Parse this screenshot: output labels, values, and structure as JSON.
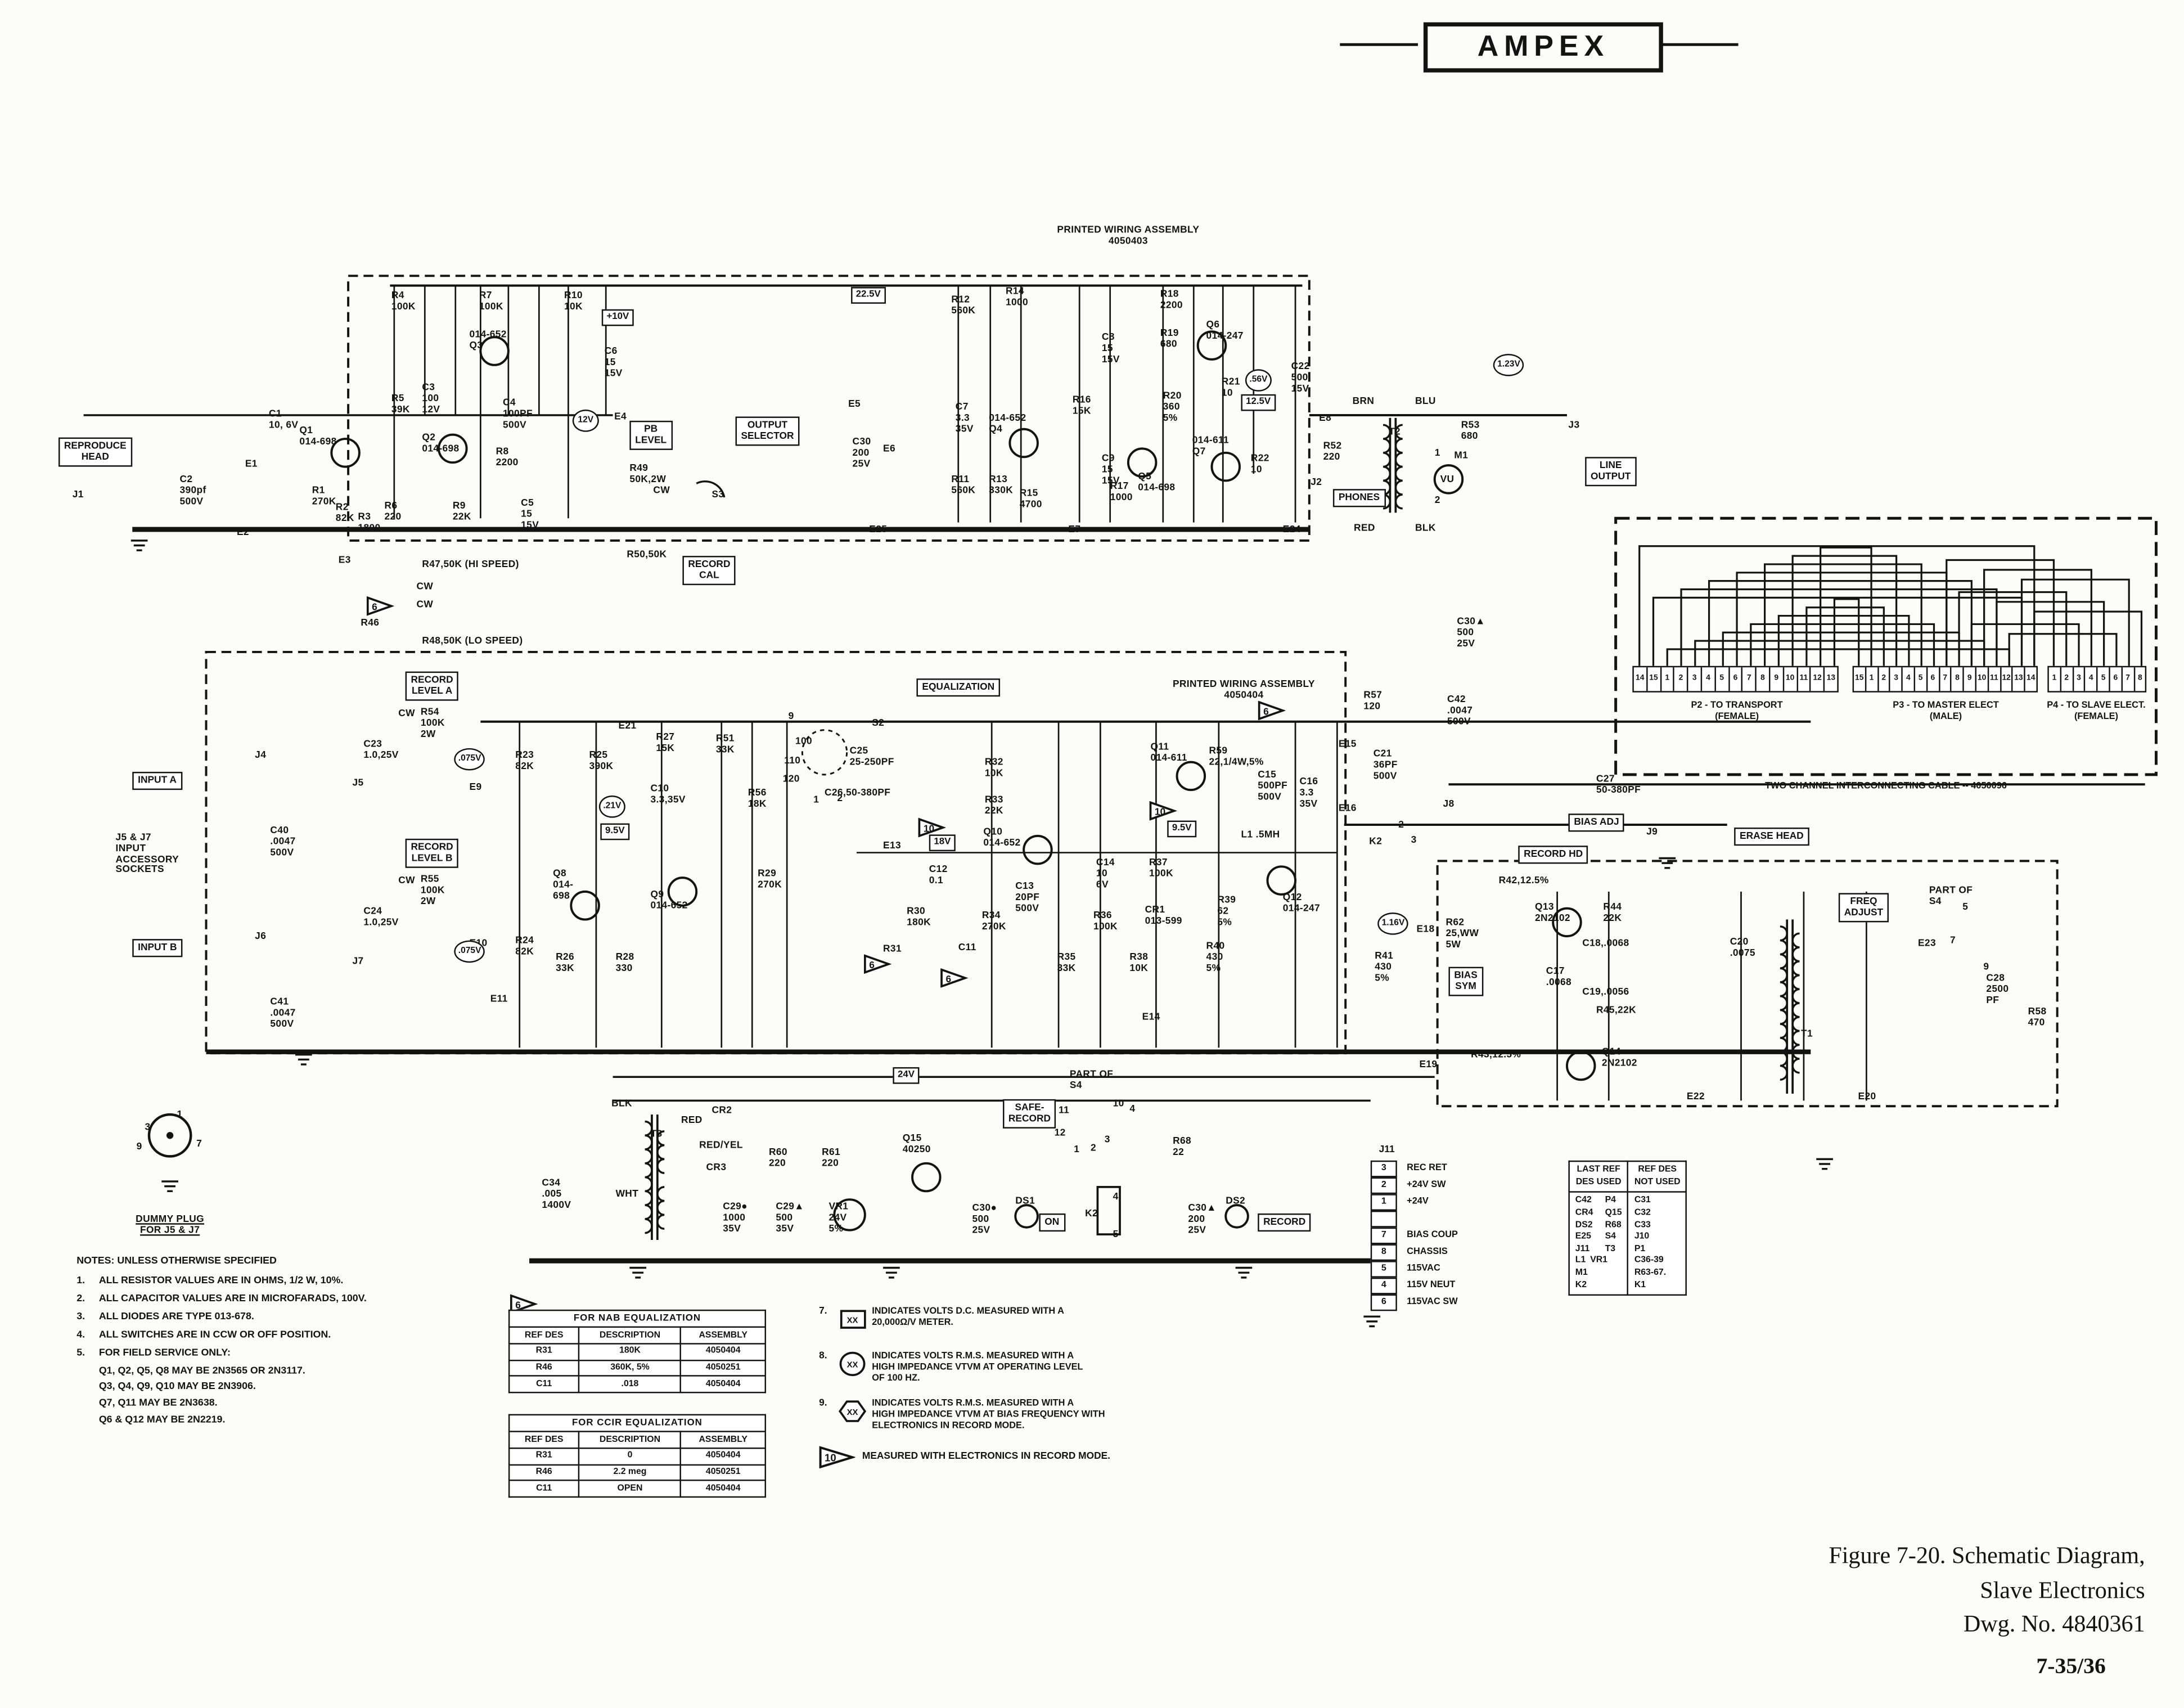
{
  "logo": {
    "text": "AMPEX"
  },
  "caption": {
    "line1": "Figure 7-20.  Schematic Diagram,",
    "line2": "Slave Electronics",
    "line3": "Dwg. No. 4840361",
    "page": "7-35/36"
  },
  "notes": {
    "title": "NOTES: UNLESS OTHERWISE SPECIFIED",
    "items": [
      {
        "n": "1.",
        "t": "ALL RESISTOR VALUES ARE IN OHMS, 1/2 W, 10%."
      },
      {
        "n": "2.",
        "t": "ALL CAPACITOR VALUES ARE IN MICROFARADS, 100V."
      },
      {
        "n": "3.",
        "t": "ALL DIODES ARE TYPE 013-678."
      },
      {
        "n": "4.",
        "t": "ALL SWITCHES ARE IN CCW OR OFF POSITION."
      },
      {
        "n": "5.",
        "t": "FOR FIELD SERVICE ONLY:",
        "subs": [
          "Q1, Q2, Q5, Q8 MAY BE 2N3565 OR 2N3117.",
          "Q3, Q4, Q9, Q10 MAY BE 2N3906.",
          "Q7, Q11 MAY BE 2N3638.",
          "Q6 & Q12  MAY BE 2N2219."
        ]
      }
    ]
  },
  "legend": [
    {
      "n": "7.",
      "shape": "box",
      "sym": "XX",
      "t": "INDICATES VOLTS D.C. MEASURED WITH A\n20,000Ω/V METER."
    },
    {
      "n": "8.",
      "shape": "circle",
      "sym": "XX",
      "t": "INDICATES VOLTS R.M.S. MEASURED WITH A\nHIGH IMPEDANCE VTVM AT OPERATING LEVEL\nOF 100 HZ."
    },
    {
      "n": "9.",
      "shape": "hex",
      "sym": "XX",
      "t": "INDICATES VOLTS R.M.S. MEASURED WITH A\nHIGH IMPEDANCE VTVM AT BIAS FREQUENCY WITH\nELECTRONICS IN RECORD MODE."
    }
  ],
  "legend10": {
    "num": "10",
    "text": "MEASURED WITH ELECTRONICS IN RECORD MODE."
  },
  "tables": {
    "nab": {
      "title": "FOR NAB EQUALIZATION",
      "headers": [
        "REF DES",
        "DESCRIPTION",
        "ASSEMBLY"
      ],
      "rows": [
        [
          "R31",
          "180K",
          "4050404"
        ],
        [
          "R46",
          "360K, 5%",
          "4050251"
        ],
        [
          "C11",
          ".018",
          "4050404"
        ]
      ]
    },
    "ccir": {
      "title": "FOR CCIR EQUALIZATION",
      "headers": [
        "REF DES",
        "DESCRIPTION",
        "ASSEMBLY"
      ],
      "rows": [
        [
          "R31",
          "0",
          "4050404"
        ],
        [
          "R46",
          "2.2 meg",
          "4050251"
        ],
        [
          "C11",
          "OPEN",
          "4050404"
        ]
      ]
    },
    "refdes": {
      "headers": [
        "LAST REF\nDES USED",
        "REF DES\nNOT USED"
      ],
      "left_col1": [
        "C42",
        "CR4",
        "DS2",
        "E25",
        "J11",
        "L1",
        "M1",
        "K2"
      ],
      "left_col2": [
        "P4",
        "Q15",
        "R68",
        "S4",
        "T3",
        "VR1"
      ],
      "right": [
        "C31",
        "C32",
        "C33",
        "J10",
        "P1",
        "C36-39",
        "R63-67.",
        "K1"
      ]
    }
  },
  "cable": {
    "caption": "TWO CHANNEL INTERCONNECTING CABLE -- 4050096",
    "p2": {
      "label": "P2 - TO TRANSPORT\n(FEMALE)",
      "pins": [
        "14",
        "15",
        "1",
        "2",
        "3",
        "4",
        "5",
        "6",
        "7",
        "8",
        "9",
        "10",
        "11",
        "12",
        "13"
      ]
    },
    "p3": {
      "label": "P3 - TO MASTER ELECT\n(MALE)",
      "pins": [
        "15",
        "1",
        "2",
        "3",
        "4",
        "5",
        "6",
        "7",
        "8",
        "9",
        "10",
        "11",
        "12",
        "13",
        "14"
      ]
    },
    "p4": {
      "label": "P4 - TO SLAVE ELECT.\n(FEMALE)",
      "pins": [
        "1",
        "2",
        "3",
        "4",
        "5",
        "6",
        "7",
        "8"
      ]
    }
  },
  "j11": {
    "label": "J11",
    "pins": [
      {
        "n": "3",
        "t": "REC RET"
      },
      {
        "n": "2",
        "t": "+24V SW"
      },
      {
        "n": "1",
        "t": "+24V"
      },
      {
        "n": "",
        "t": ""
      },
      {
        "n": "7",
        "t": "BIAS COUP"
      },
      {
        "n": "8",
        "t": "CHASSIS"
      },
      {
        "n": "5",
        "t": "115VAC"
      },
      {
        "n": "4",
        "t": "115V NEUT"
      },
      {
        "n": "6",
        "t": "115VAC SW"
      }
    ]
  },
  "schematic": {
    "boxes": [
      [
        "REPRODUCE\nHEAD",
        42,
        314
      ],
      [
        "INPUT A",
        95,
        554
      ],
      [
        "INPUT B",
        95,
        674
      ],
      [
        "PB\nLEVEL",
        452,
        302
      ],
      [
        "OUTPUT\nSELECTOR",
        528,
        299
      ],
      [
        "RECORD\nCAL",
        490,
        399
      ],
      [
        "RECORD\nLEVEL A",
        291,
        482
      ],
      [
        "RECORD\nLEVEL B",
        291,
        602
      ],
      [
        "EQUALIZATION",
        658,
        487
      ],
      [
        "PHONES",
        957,
        351
      ],
      [
        "LINE\nOUTPUT",
        1138,
        328
      ],
      [
        "SAFE-\nRECORD",
        720,
        789
      ],
      [
        "ON",
        746,
        871
      ],
      [
        "RECORD",
        903,
        871
      ],
      [
        "BIAS ADJ",
        1126,
        584
      ],
      [
        "RECORD HD",
        1090,
        607
      ],
      [
        "ERASE HEAD",
        1245,
        594
      ],
      [
        "FREQ\nADJUST",
        1320,
        641
      ],
      [
        "BIAS\nSYM",
        1040,
        694
      ]
    ],
    "vboxes": [
      [
        "22.5V",
        611,
        206
      ],
      [
        "+10V",
        432,
        222
      ],
      [
        "12.5V",
        891,
        283
      ],
      [
        "18V",
        667,
        599
      ],
      [
        "9.5V",
        431,
        591
      ],
      [
        "9.5V",
        838,
        589
      ],
      [
        "24V",
        641,
        766
      ]
    ],
    "vcircles": [
      [
        "12V",
        411,
        294
      ],
      [
        ".56V",
        894,
        265
      ],
      [
        "1.23V",
        1072,
        254
      ],
      [
        ".075V",
        326,
        537
      ],
      [
        ".075V",
        326,
        675
      ],
      [
        ".21V",
        430,
        571
      ],
      [
        "1.16V",
        989,
        655
      ]
    ],
    "tris": [
      [
        "6",
        263,
        428
      ],
      [
        "6",
        366,
        929
      ],
      [
        "10",
        659,
        587
      ],
      [
        "10",
        825,
        575
      ],
      [
        "6",
        620,
        685
      ],
      [
        "6",
        675,
        695
      ],
      [
        "6",
        903,
        503
      ]
    ],
    "labels": [
      [
        "C1\n10, 6V",
        193,
        294
      ],
      [
        "E1",
        176,
        330
      ],
      [
        "C2\n390pf\n500V",
        129,
        341
      ],
      [
        "J1",
        52,
        352
      ],
      [
        "Q1\n014-698",
        215,
        306
      ],
      [
        "R1\n270K",
        224,
        349
      ],
      [
        "R2\n82K",
        241,
        361
      ],
      [
        "R3\n1800",
        257,
        368
      ],
      [
        "R6\n220",
        276,
        360
      ],
      [
        "E2",
        170,
        379
      ],
      [
        "E3",
        243,
        399
      ],
      [
        "R4\n100K",
        281,
        209
      ],
      [
        "R5\n39K",
        281,
        283
      ],
      [
        "C3\n100\n12V",
        303,
        275
      ],
      [
        "Q2\n014-698",
        303,
        311
      ],
      [
        "R7\n100K",
        344,
        209
      ],
      [
        "014-652\nQ3",
        337,
        237
      ],
      [
        "C4\n100PF\n500V",
        361,
        286
      ],
      [
        "R8\n2200",
        356,
        321
      ],
      [
        "R9\n22K",
        325,
        360
      ],
      [
        "C5\n15\n15V",
        374,
        358
      ],
      [
        "R10\n10K",
        405,
        209
      ],
      [
        "C6\n15\n15V",
        434,
        249
      ],
      [
        "R47,50K (HI SPEED)",
        303,
        402
      ],
      [
        "CW",
        299,
        418
      ],
      [
        "CW",
        299,
        431
      ],
      [
        "R46",
        259,
        444
      ],
      [
        "R48,50K (LO SPEED)",
        303,
        457
      ],
      [
        "E4",
        441,
        296
      ],
      [
        "R49\n50K,2W",
        452,
        333
      ],
      [
        "CW",
        469,
        349
      ],
      [
        "S3",
        511,
        352
      ],
      [
        "R50,50K",
        450,
        395
      ],
      [
        "E21",
        444,
        518
      ],
      [
        "PRINTED WIRING ASSEMBLY\n4050403",
        810,
        162,
        "ctr"
      ],
      [
        "E5",
        609,
        287
      ],
      [
        "C30\n200\n25V",
        612,
        314
      ],
      [
        "E6",
        634,
        319
      ],
      [
        "C7\n3.3\n35V",
        686,
        289
      ],
      [
        "014-652\nQ4",
        710,
        297
      ],
      [
        "R11\n560K",
        683,
        341
      ],
      [
        "R13\n330K",
        710,
        341
      ],
      [
        "R15\n4700",
        732,
        351
      ],
      [
        "R12\n560K",
        683,
        212
      ],
      [
        "R14\n1000",
        722,
        206
      ],
      [
        "E25",
        624,
        377
      ],
      [
        "E7",
        767,
        377
      ],
      [
        "R18\n2200",
        833,
        208
      ],
      [
        "R19\n680",
        833,
        236
      ],
      [
        "Q6\n014-247",
        866,
        230
      ],
      [
        "C8\n15\n15V",
        791,
        239
      ],
      [
        "R16\n15K",
        770,
        284
      ],
      [
        "R20\n360\n5%",
        835,
        281
      ],
      [
        "R21\n10",
        877,
        271
      ],
      [
        "C22\n500\n15V",
        927,
        260
      ],
      [
        "R17\n1000",
        797,
        346
      ],
      [
        "Q5\n014-698",
        817,
        339
      ],
      [
        "C9\n15\n15V",
        791,
        326
      ],
      [
        "014-611\nQ7",
        856,
        313
      ],
      [
        "R22\n10",
        898,
        326
      ],
      [
        "E8",
        947,
        297
      ],
      [
        "E24",
        921,
        377
      ],
      [
        "BRN",
        971,
        285
      ],
      [
        "BLU",
        1016,
        285
      ],
      [
        "RED",
        972,
        376
      ],
      [
        "BLK",
        1016,
        376
      ],
      [
        "T2",
        997,
        307
      ],
      [
        "R52\n220",
        950,
        317
      ],
      [
        "J2",
        941,
        343
      ],
      [
        "1",
        1030,
        322
      ],
      [
        "M1",
        1044,
        324
      ],
      [
        "2",
        1030,
        356
      ],
      [
        "VU",
        1034,
        341
      ],
      [
        "R53\n680",
        1049,
        302
      ],
      [
        "J3",
        1126,
        302
      ],
      [
        "PRINTED WIRING ASSEMBLY\n4050404",
        893,
        488,
        "ctr"
      ],
      [
        "R57\n120",
        979,
        496
      ],
      [
        "E15",
        961,
        531
      ],
      [
        "C21\n36PF\n500V",
        986,
        538
      ],
      [
        "C30▲\n500\n25V",
        1046,
        443
      ],
      [
        "C42\n.0047\n500V",
        1039,
        499
      ],
      [
        "R23\n82K",
        370,
        539
      ],
      [
        "R25\n390K",
        423,
        539
      ],
      [
        "R27\n15K",
        471,
        526
      ],
      [
        "R51\n33K",
        514,
        527
      ],
      [
        "C10\n3.3,35V",
        467,
        563
      ],
      [
        "R56\n18K",
        537,
        566
      ],
      [
        "Q8\n014-\n698",
        397,
        624
      ],
      [
        "Q9\n014-652",
        467,
        639
      ],
      [
        "R24\n82K",
        370,
        672
      ],
      [
        "R26\n33K",
        399,
        684
      ],
      [
        "R28\n330",
        442,
        684
      ],
      [
        "R29\n270K",
        544,
        624
      ],
      [
        "E13",
        634,
        604
      ],
      [
        "S2",
        626,
        516
      ],
      [
        "9",
        566,
        511
      ],
      [
        "100",
        571,
        529
      ],
      [
        "110",
        563,
        543
      ],
      [
        "120",
        562,
        556
      ],
      [
        "1",
        584,
        571
      ],
      [
        "2",
        601,
        570
      ],
      [
        "C25\n25-250PF",
        610,
        536
      ],
      [
        "C26,50-380PF",
        592,
        566
      ],
      [
        "R32\n10K",
        707,
        544
      ],
      [
        "R33\n22K",
        707,
        571
      ],
      [
        "Q10\n014-652",
        706,
        594
      ],
      [
        "C12\n0.1",
        667,
        621
      ],
      [
        "C13\n20PF\n500V",
        729,
        633
      ],
      [
        "C14\n10\n6V",
        787,
        616
      ],
      [
        "R37\n100K",
        825,
        616
      ],
      [
        "R30\n180K",
        651,
        651
      ],
      [
        "R34\n270K",
        705,
        654
      ],
      [
        "R36\n100K",
        785,
        654
      ],
      [
        "CR1\n013-599",
        822,
        650
      ],
      [
        "R35\n33K",
        759,
        684
      ],
      [
        "R38\n10K",
        811,
        684
      ],
      [
        "R31",
        634,
        678
      ],
      [
        "C11",
        688,
        677
      ],
      [
        "E14",
        820,
        727
      ],
      [
        "Q11\n014-611",
        826,
        533
      ],
      [
        "R59\n22,1/4W,5%",
        868,
        536
      ],
      [
        "C15\n500PF\n500V",
        903,
        553
      ],
      [
        "C16\n3.3\n35V",
        933,
        558
      ],
      [
        "L1 .5MH",
        891,
        596
      ],
      [
        "E16",
        961,
        577
      ],
      [
        "K2",
        983,
        601
      ],
      [
        "2",
        1004,
        589
      ],
      [
        "3",
        1013,
        600
      ],
      [
        "J8",
        1036,
        574
      ],
      [
        "C27\n50-380PF",
        1146,
        556
      ],
      [
        "J9",
        1182,
        594
      ],
      [
        "R39\n62\n5%",
        874,
        643
      ],
      [
        "Q12\n014-247",
        921,
        641
      ],
      [
        "R40\n430\n5%",
        866,
        676
      ],
      [
        "E18",
        1017,
        664
      ],
      [
        "R62\n25,WW\n5W",
        1038,
        659
      ],
      [
        "R41\n430\n5%",
        987,
        683
      ],
      [
        "R42,12.5%",
        1076,
        629
      ],
      [
        "Q13\n2N2102",
        1102,
        648
      ],
      [
        "R44\n22K",
        1151,
        648
      ],
      [
        "C18,.0068",
        1136,
        674
      ],
      [
        "C17\n.0068",
        1110,
        694
      ],
      [
        "C19,.0056",
        1136,
        709
      ],
      [
        "R45,22K",
        1146,
        722
      ],
      [
        "Q14\n2N2102",
        1150,
        752
      ],
      [
        "R43,12.5%",
        1056,
        754
      ],
      [
        "E19",
        1019,
        761
      ],
      [
        "C20\n.0075",
        1242,
        673
      ],
      [
        "T1",
        1293,
        739
      ],
      [
        "PART OF\nS4",
        1385,
        636
      ],
      [
        "E23",
        1377,
        674
      ],
      [
        "5",
        1409,
        648
      ],
      [
        "7",
        1400,
        672
      ],
      [
        "9",
        1424,
        691
      ],
      [
        "C28\n2500\nPF",
        1426,
        699
      ],
      [
        "R58\n470",
        1456,
        723
      ],
      [
        "E22",
        1211,
        784
      ],
      [
        "E20",
        1334,
        784
      ],
      [
        "BLK",
        439,
        789
      ],
      [
        "T3",
        467,
        811
      ],
      [
        "RED",
        489,
        801
      ],
      [
        "CR2",
        511,
        794
      ],
      [
        "RED/YEL",
        502,
        819
      ],
      [
        "CR3",
        507,
        835
      ],
      [
        "R60\n220",
        552,
        824
      ],
      [
        "R61\n220",
        590,
        824
      ],
      [
        "Q15\n40250",
        648,
        814
      ],
      [
        "C34\n.005\n1400V",
        389,
        846
      ],
      [
        "WHT",
        442,
        854
      ],
      [
        "C29●\n1000\n35V",
        519,
        863
      ],
      [
        "C29▲\n500\n35V",
        557,
        863
      ],
      [
        "VR1\n24V\n5%",
        595,
        863
      ],
      [
        "C30●\n500\n25V",
        698,
        864
      ],
      [
        "DS1",
        729,
        859
      ],
      [
        "K2",
        779,
        868
      ],
      [
        "4",
        799,
        856
      ],
      [
        "5",
        799,
        883
      ],
      [
        "C30▲\n200\n25V",
        853,
        864
      ],
      [
        "DS2",
        880,
        859
      ],
      [
        "PART OF\nS4",
        768,
        768
      ],
      [
        "11",
        760,
        794
      ],
      [
        "12",
        757,
        810
      ],
      [
        "1",
        771,
        822
      ],
      [
        "2",
        783,
        821
      ],
      [
        "3",
        793,
        815
      ],
      [
        "10",
        799,
        789
      ],
      [
        "4",
        811,
        793
      ],
      [
        "R68\n22",
        842,
        816
      ],
      [
        "J4",
        183,
        539
      ],
      [
        "J5",
        253,
        559
      ],
      [
        "J6",
        183,
        669
      ],
      [
        "J7",
        253,
        687
      ],
      [
        "CW",
        286,
        509
      ],
      [
        "R54\n100K\n2W",
        302,
        508
      ],
      [
        "C23\n1.0,25V",
        261,
        531
      ],
      [
        "E9",
        337,
        562
      ],
      [
        "CW",
        286,
        629
      ],
      [
        "R55\n100K\n2W",
        302,
        628
      ],
      [
        "C24\n1.0,25V",
        261,
        651
      ],
      [
        "E10",
        337,
        674
      ],
      [
        "E11",
        352,
        714
      ],
      [
        "C40\n.0047\n500V",
        194,
        593
      ],
      [
        "C41\n.0047\n500V",
        194,
        716
      ],
      [
        "J5 & J7\nINPUT\nACCESSORY\nSOCKETS",
        83,
        598
      ],
      [
        "3",
        104,
        806
      ],
      [
        "1",
        127,
        797
      ],
      [
        "9",
        98,
        820
      ],
      [
        "7",
        141,
        818
      ]
    ]
  },
  "dummy_plug": {
    "label": "DUMMY PLUG\nFOR J5 & J7"
  }
}
